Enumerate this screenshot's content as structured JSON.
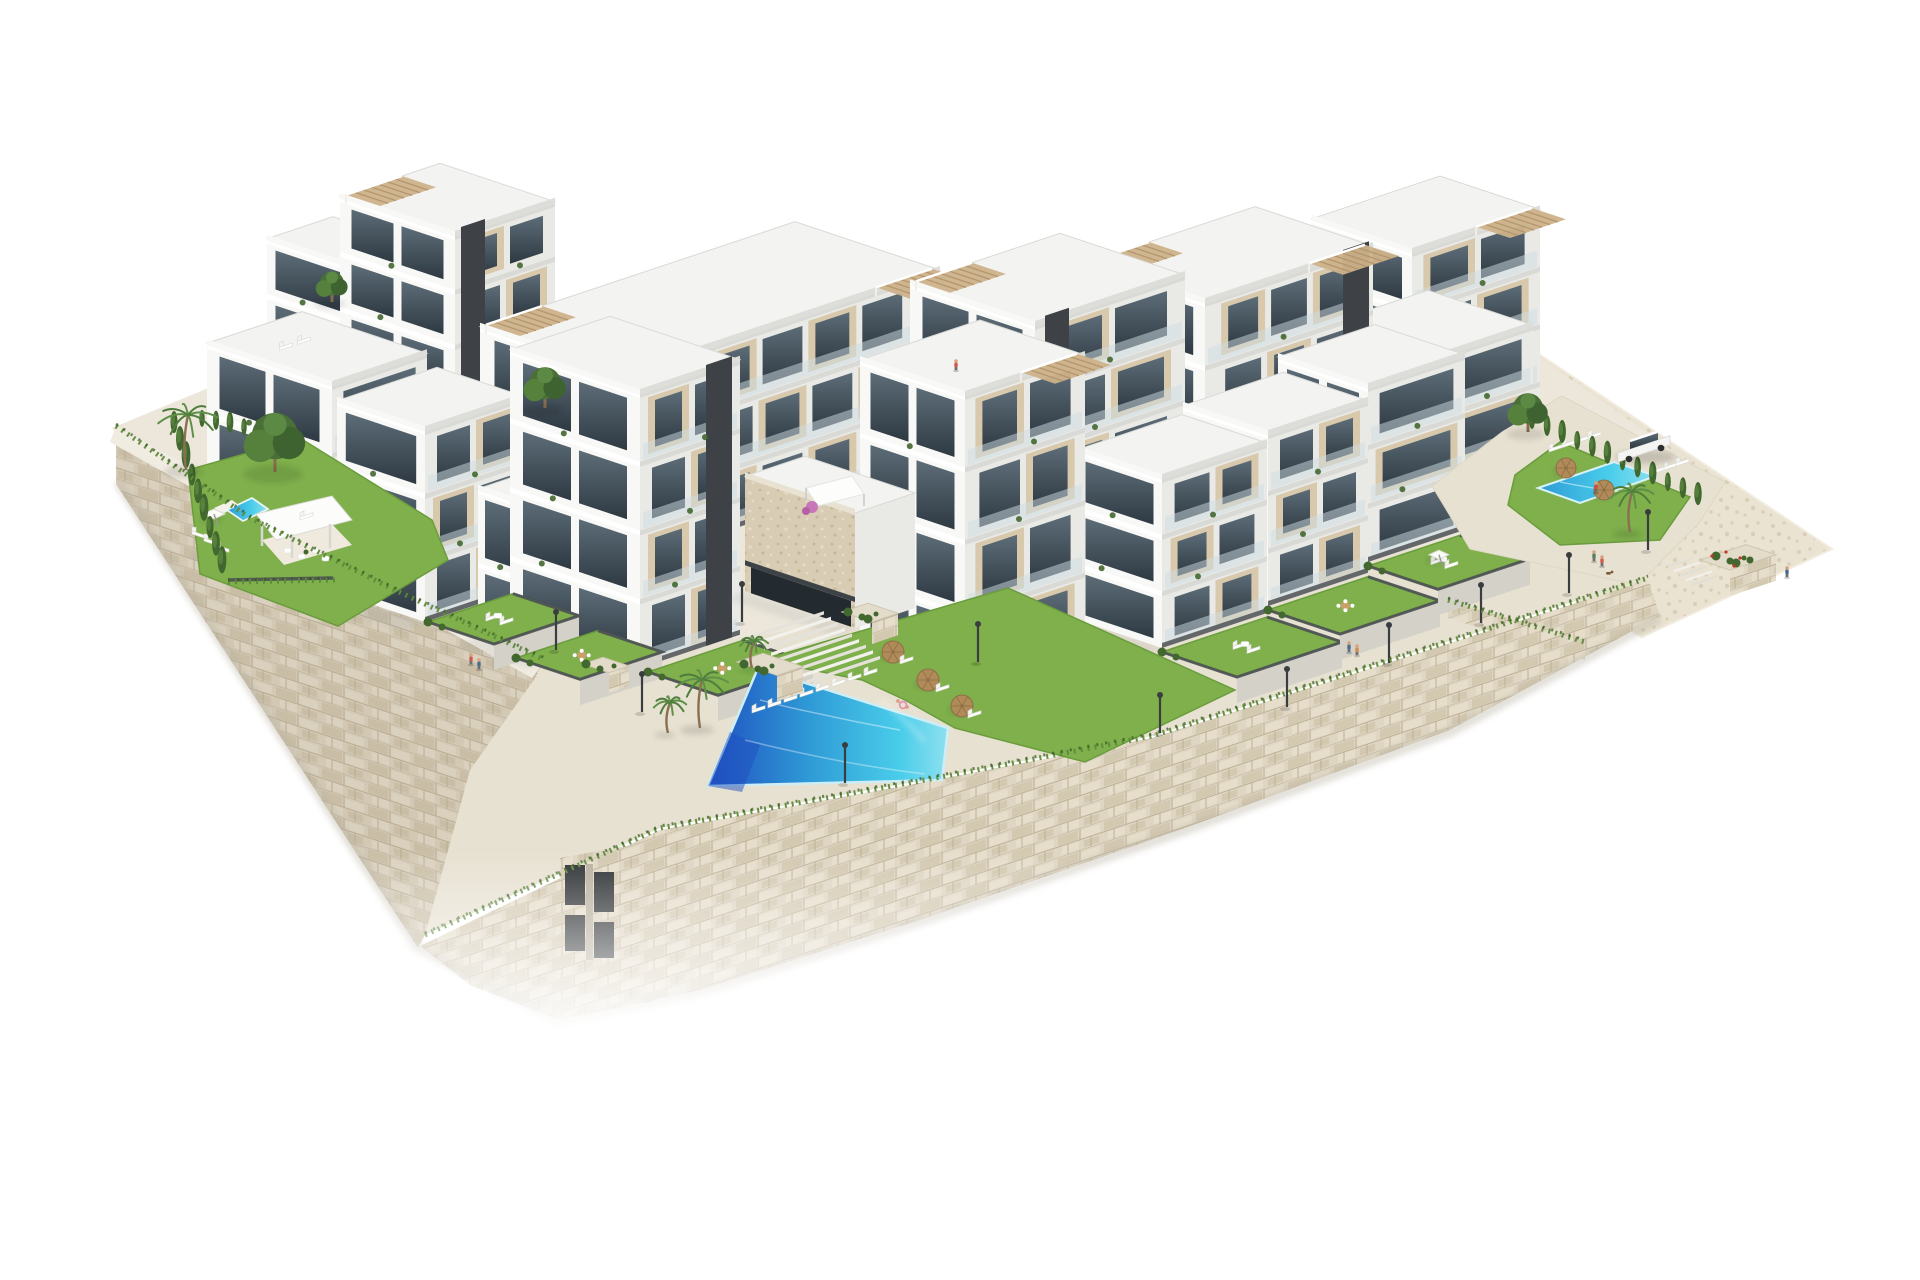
{
  "scene": {
    "title": "Aerial 3D architectural rendering of a terraced hillside apartment complex with swimming pools on a white background",
    "type": "architectural-3d-render",
    "view": "isometric aerial view from the south-east",
    "background": "#ffffff",
    "features": {
      "apartment_blocks": 16,
      "storeys_range": "2 to 4",
      "roof_pergolas": 7,
      "swimming_pools": [
        {
          "name": "main communal pool",
          "location": "center, below the stairs",
          "shape": "trapezoid",
          "water": "deep blue to turquoise"
        },
        {
          "name": "secondary communal pool",
          "location": "right terrace near parking",
          "water": "turquoise"
        },
        {
          "name": "private garden pool",
          "location": "left communal garden",
          "water": "turquoise"
        }
      ],
      "landscape": [
        "beige stone retaining walls with grass tufts",
        "stone-clad community house",
        "private lawn terraces with dark fences",
        "cypress hedges",
        "palm trees",
        "pine trees",
        "white sun loungers",
        "straw parasols",
        "white shade sails",
        "street lamps along promenade",
        "central staircase with planters",
        "white parked car",
        "pedestrians walking a dog",
        "swimmers in the main pool",
        "pink bougainvillea"
      ]
    }
  },
  "palette": {
    "paper": "#ffffff",
    "pav1": "#ece7da",
    "pav2": "#e7e1d1",
    "pavLight": "#f1ece1",
    "slope1": "#eae3d2",
    "slope2": "#d8cfb8",
    "stone1": "#d9cfbb",
    "stone2": "#cfc4ab",
    "stone3": "#e1d8c5",
    "stoneLine": "#bdb096",
    "stoneB1": "#ded5c2",
    "stoneB2": "#d3c8b0",
    "stoneB3": "#e6ddcb",
    "concrete": "#d4d1c8",
    "bldgWhite": "#f8f8f6",
    "bldgShade": "#e9e9e6",
    "bldgShade2": "#dddddA",
    "bldgTop": "#f3f3f1",
    "slab": "#ffffff",
    "slabShade": "#d9d9d6",
    "beige": "#d8c8ac",
    "beigeDark": "#c8b493",
    "glassHi": "#5d6d78",
    "glassLo": "#2e3942",
    "core": "#3e4246",
    "fence": "#4d5154",
    "balu": "#cfdde3",
    "grassBright": "#7fb04c",
    "grassMid": "#6b9c3d",
    "grassDark": "#567f2f",
    "hedge": "#42672f",
    "hedgeDark": "#35541f",
    "pine": "#4a7038",
    "palmGreen": "#4f7d3c",
    "tuft": "#5d8b3a",
    "poolDeep": "#1f4fc0",
    "poolMid": "#2f9ad6",
    "poolLight": "#49cdea",
    "poolPale": "#8fe0ef",
    "parasol": "#b08b59",
    "parasolDark": "#8e6f45",
    "pergola": "#cdb28a",
    "pergStripe": "#b3966c",
    "lamp": "#3a3d3f",
    "skin": "#d8a47f",
    "shadowCol": "#8d939b",
    "flowerPink": "#c777b9",
    "flowerRed": "#c0392b",
    "trunk": "#8a6f52"
  }
}
